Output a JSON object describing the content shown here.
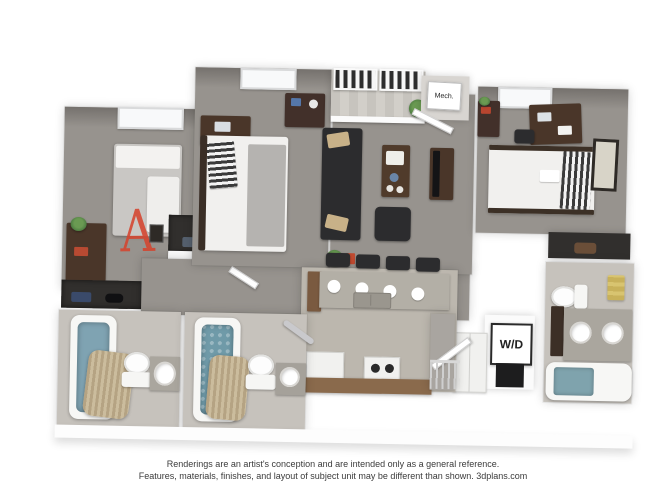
{
  "plan": {
    "unit_letter": "A",
    "labels": {
      "mech_closet": "Mech.",
      "washer_dryer": "W/D"
    }
  },
  "caption": {
    "line1": "Renderings are an artist's conception and are intended only as a general reference.",
    "line2": "Features, materials, finishes, and layout of subject unit may be different than shown. 3dplans.com"
  },
  "colors": {
    "background": "#ffffff",
    "walls": "#fdfdfd",
    "carpet": "#97938e",
    "bath_tile": "#c6c2bc",
    "kitchen_tile": "#bcb7ae",
    "wood_furniture": "#4a3629",
    "sofa_charcoal": "#2c2c2e",
    "granite": "#aaa69e",
    "tub_water_blue": "#7fa3b2",
    "accent_pillow_tan": "#c8b188",
    "towel_gold": "#c8b15a",
    "annotation_red": "#d5452f",
    "caption_text": "#3b3b3b"
  }
}
